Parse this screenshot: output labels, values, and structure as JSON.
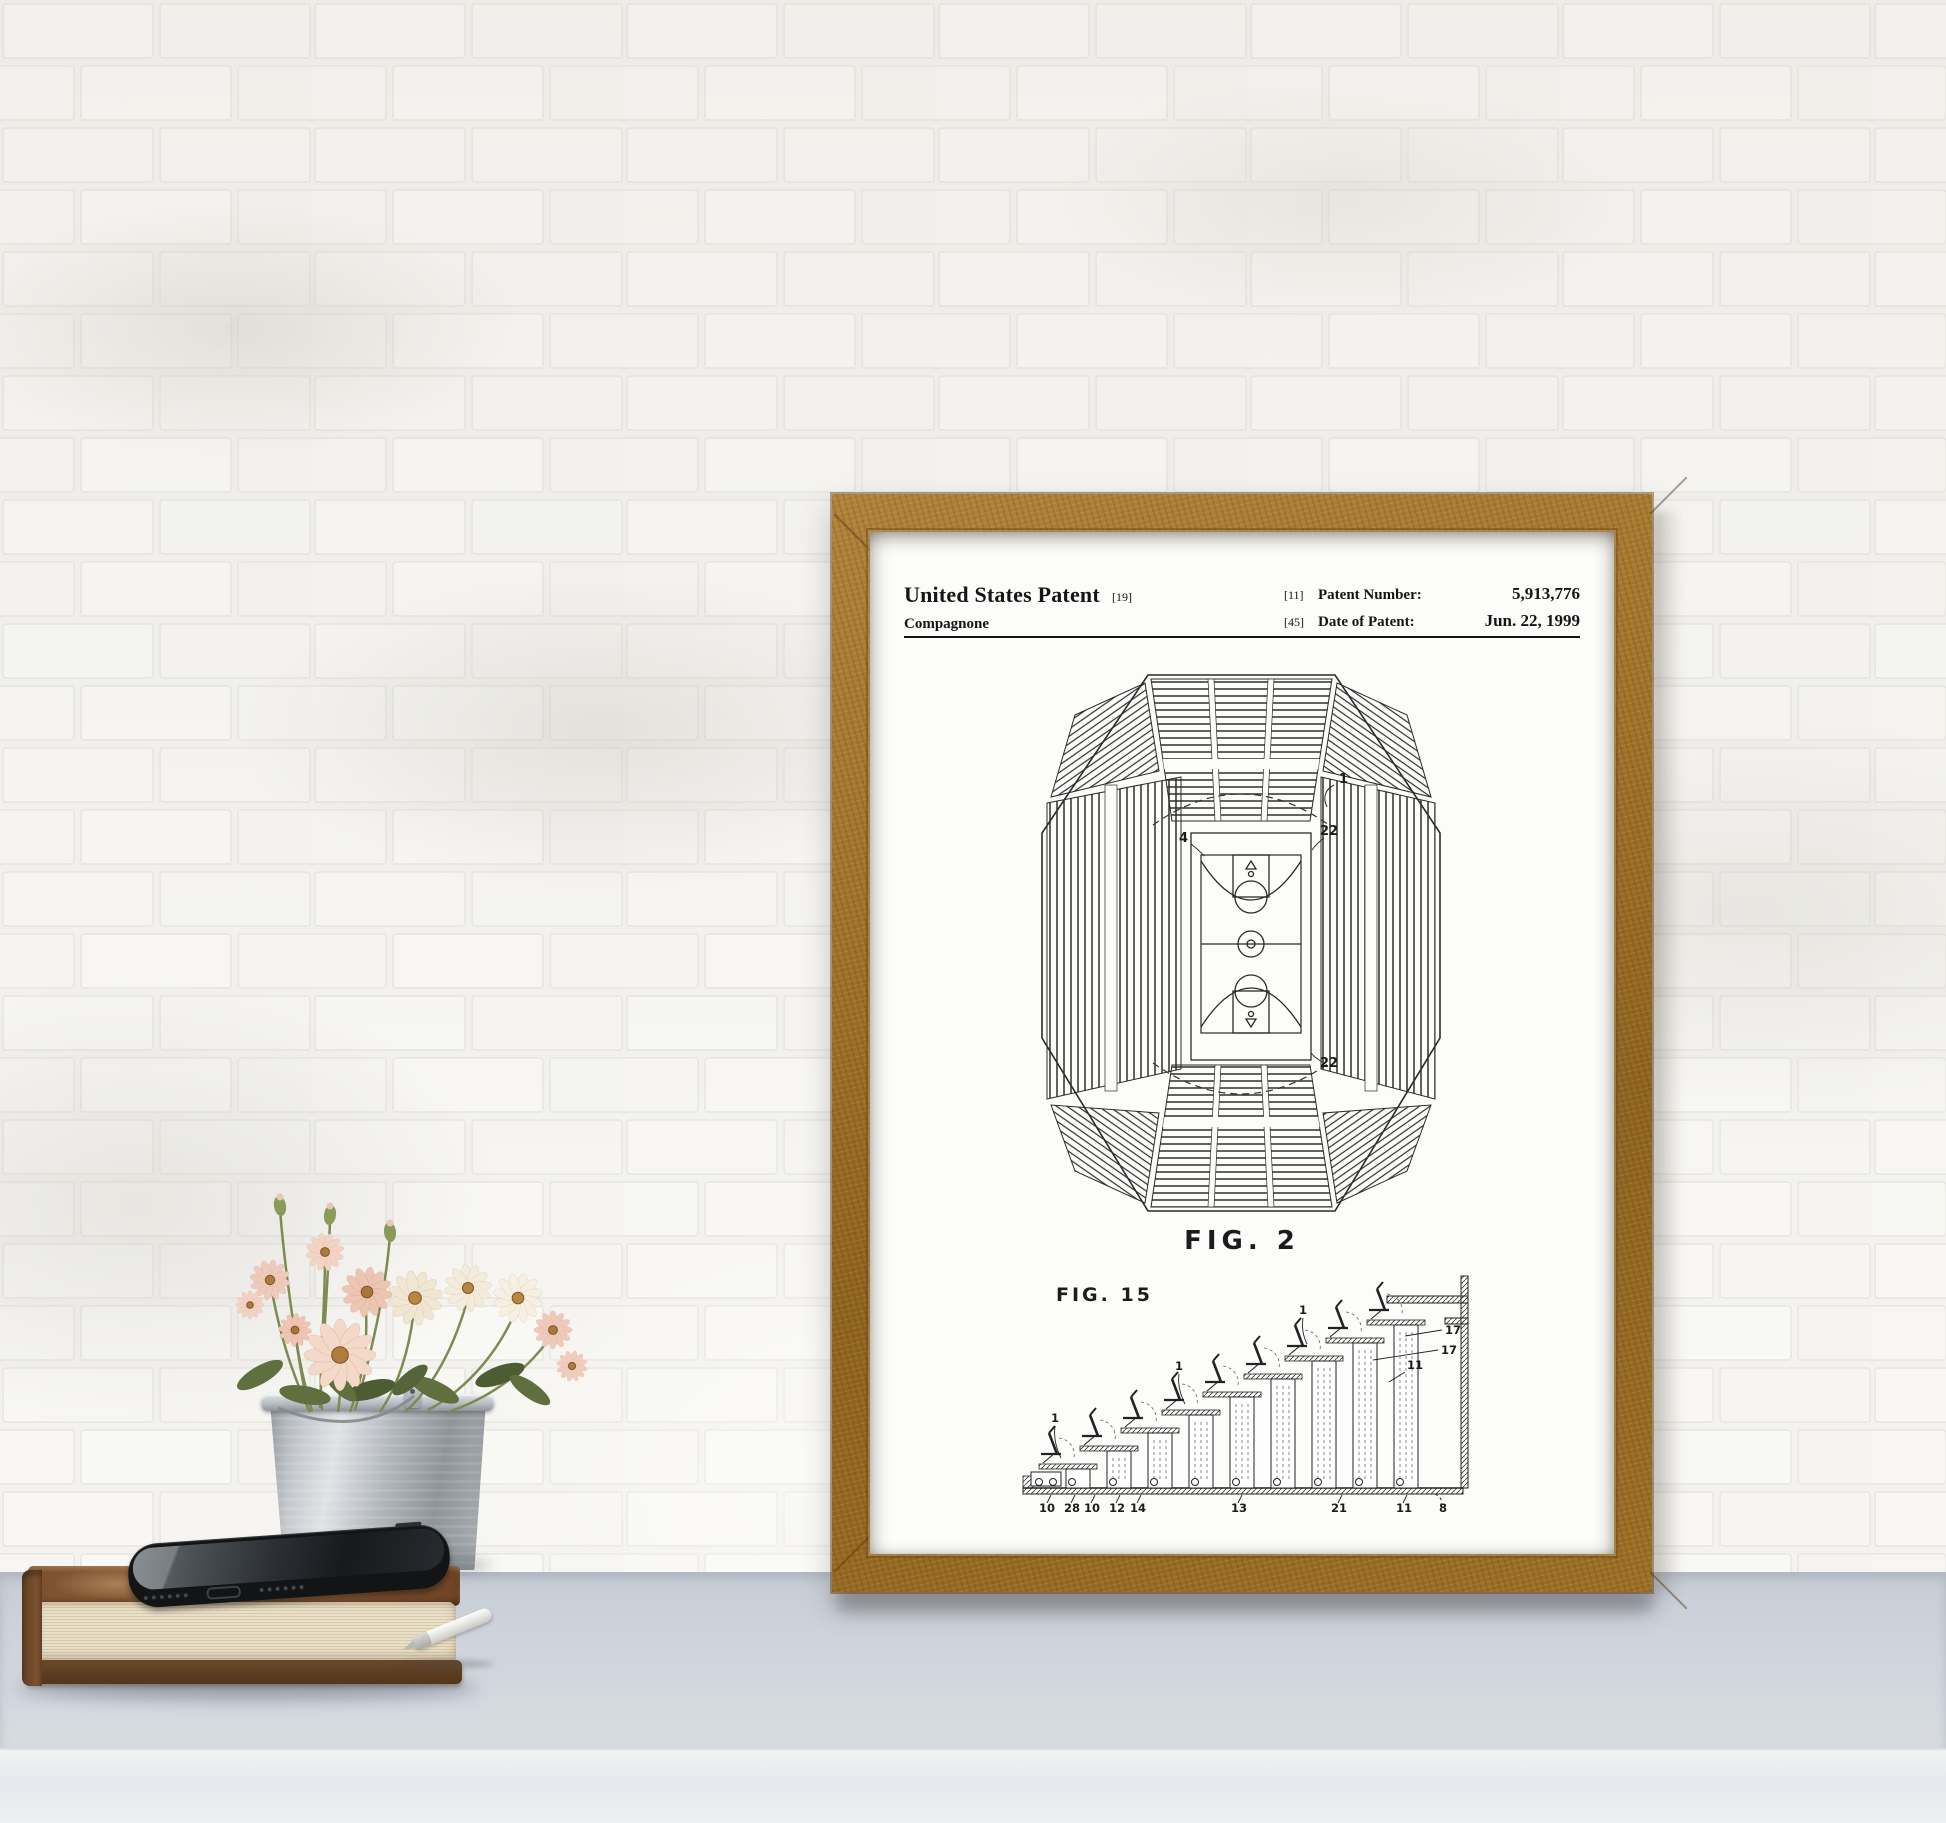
{
  "poster": {
    "header": {
      "title": "United States Patent",
      "title_code": "[19]",
      "inventor": "Compagnone",
      "patent_number_code": "[11]",
      "patent_number_label": "Patent Number:",
      "patent_number": "5,913,776",
      "date_code": "[45]",
      "date_label": "Date of Patent:",
      "date_value": "Jun. 22, 1999"
    },
    "fig2": {
      "caption": "FIG. 2",
      "ref_arena": "1",
      "ref_gap_top": "22",
      "ref_gap_bottom": "22",
      "ref_court": "4"
    },
    "fig15": {
      "caption": "FIG. 15",
      "seat_ref": "1",
      "right_refs": [
        "17",
        "17",
        "11"
      ],
      "bottom_refs": [
        "10",
        "28",
        "10",
        "12",
        "14",
        "13",
        "21",
        "11",
        "8"
      ]
    }
  }
}
